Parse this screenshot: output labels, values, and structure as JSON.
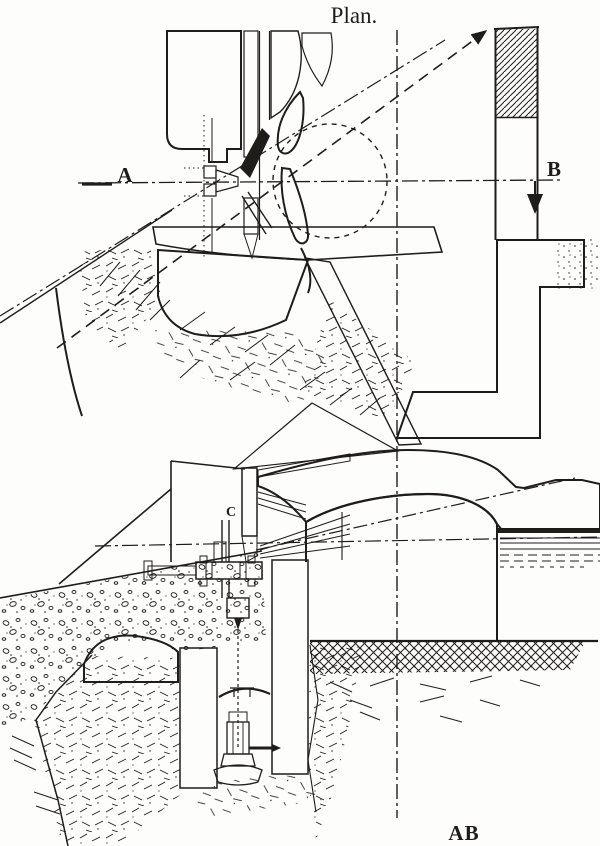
{
  "figure": {
    "title": "Plan.",
    "label_a": "A",
    "label_b": "B",
    "label_c": "C",
    "section_label": "AB",
    "ink_color": "#1f1d1a",
    "paper_color": "#fdfdfb"
  }
}
